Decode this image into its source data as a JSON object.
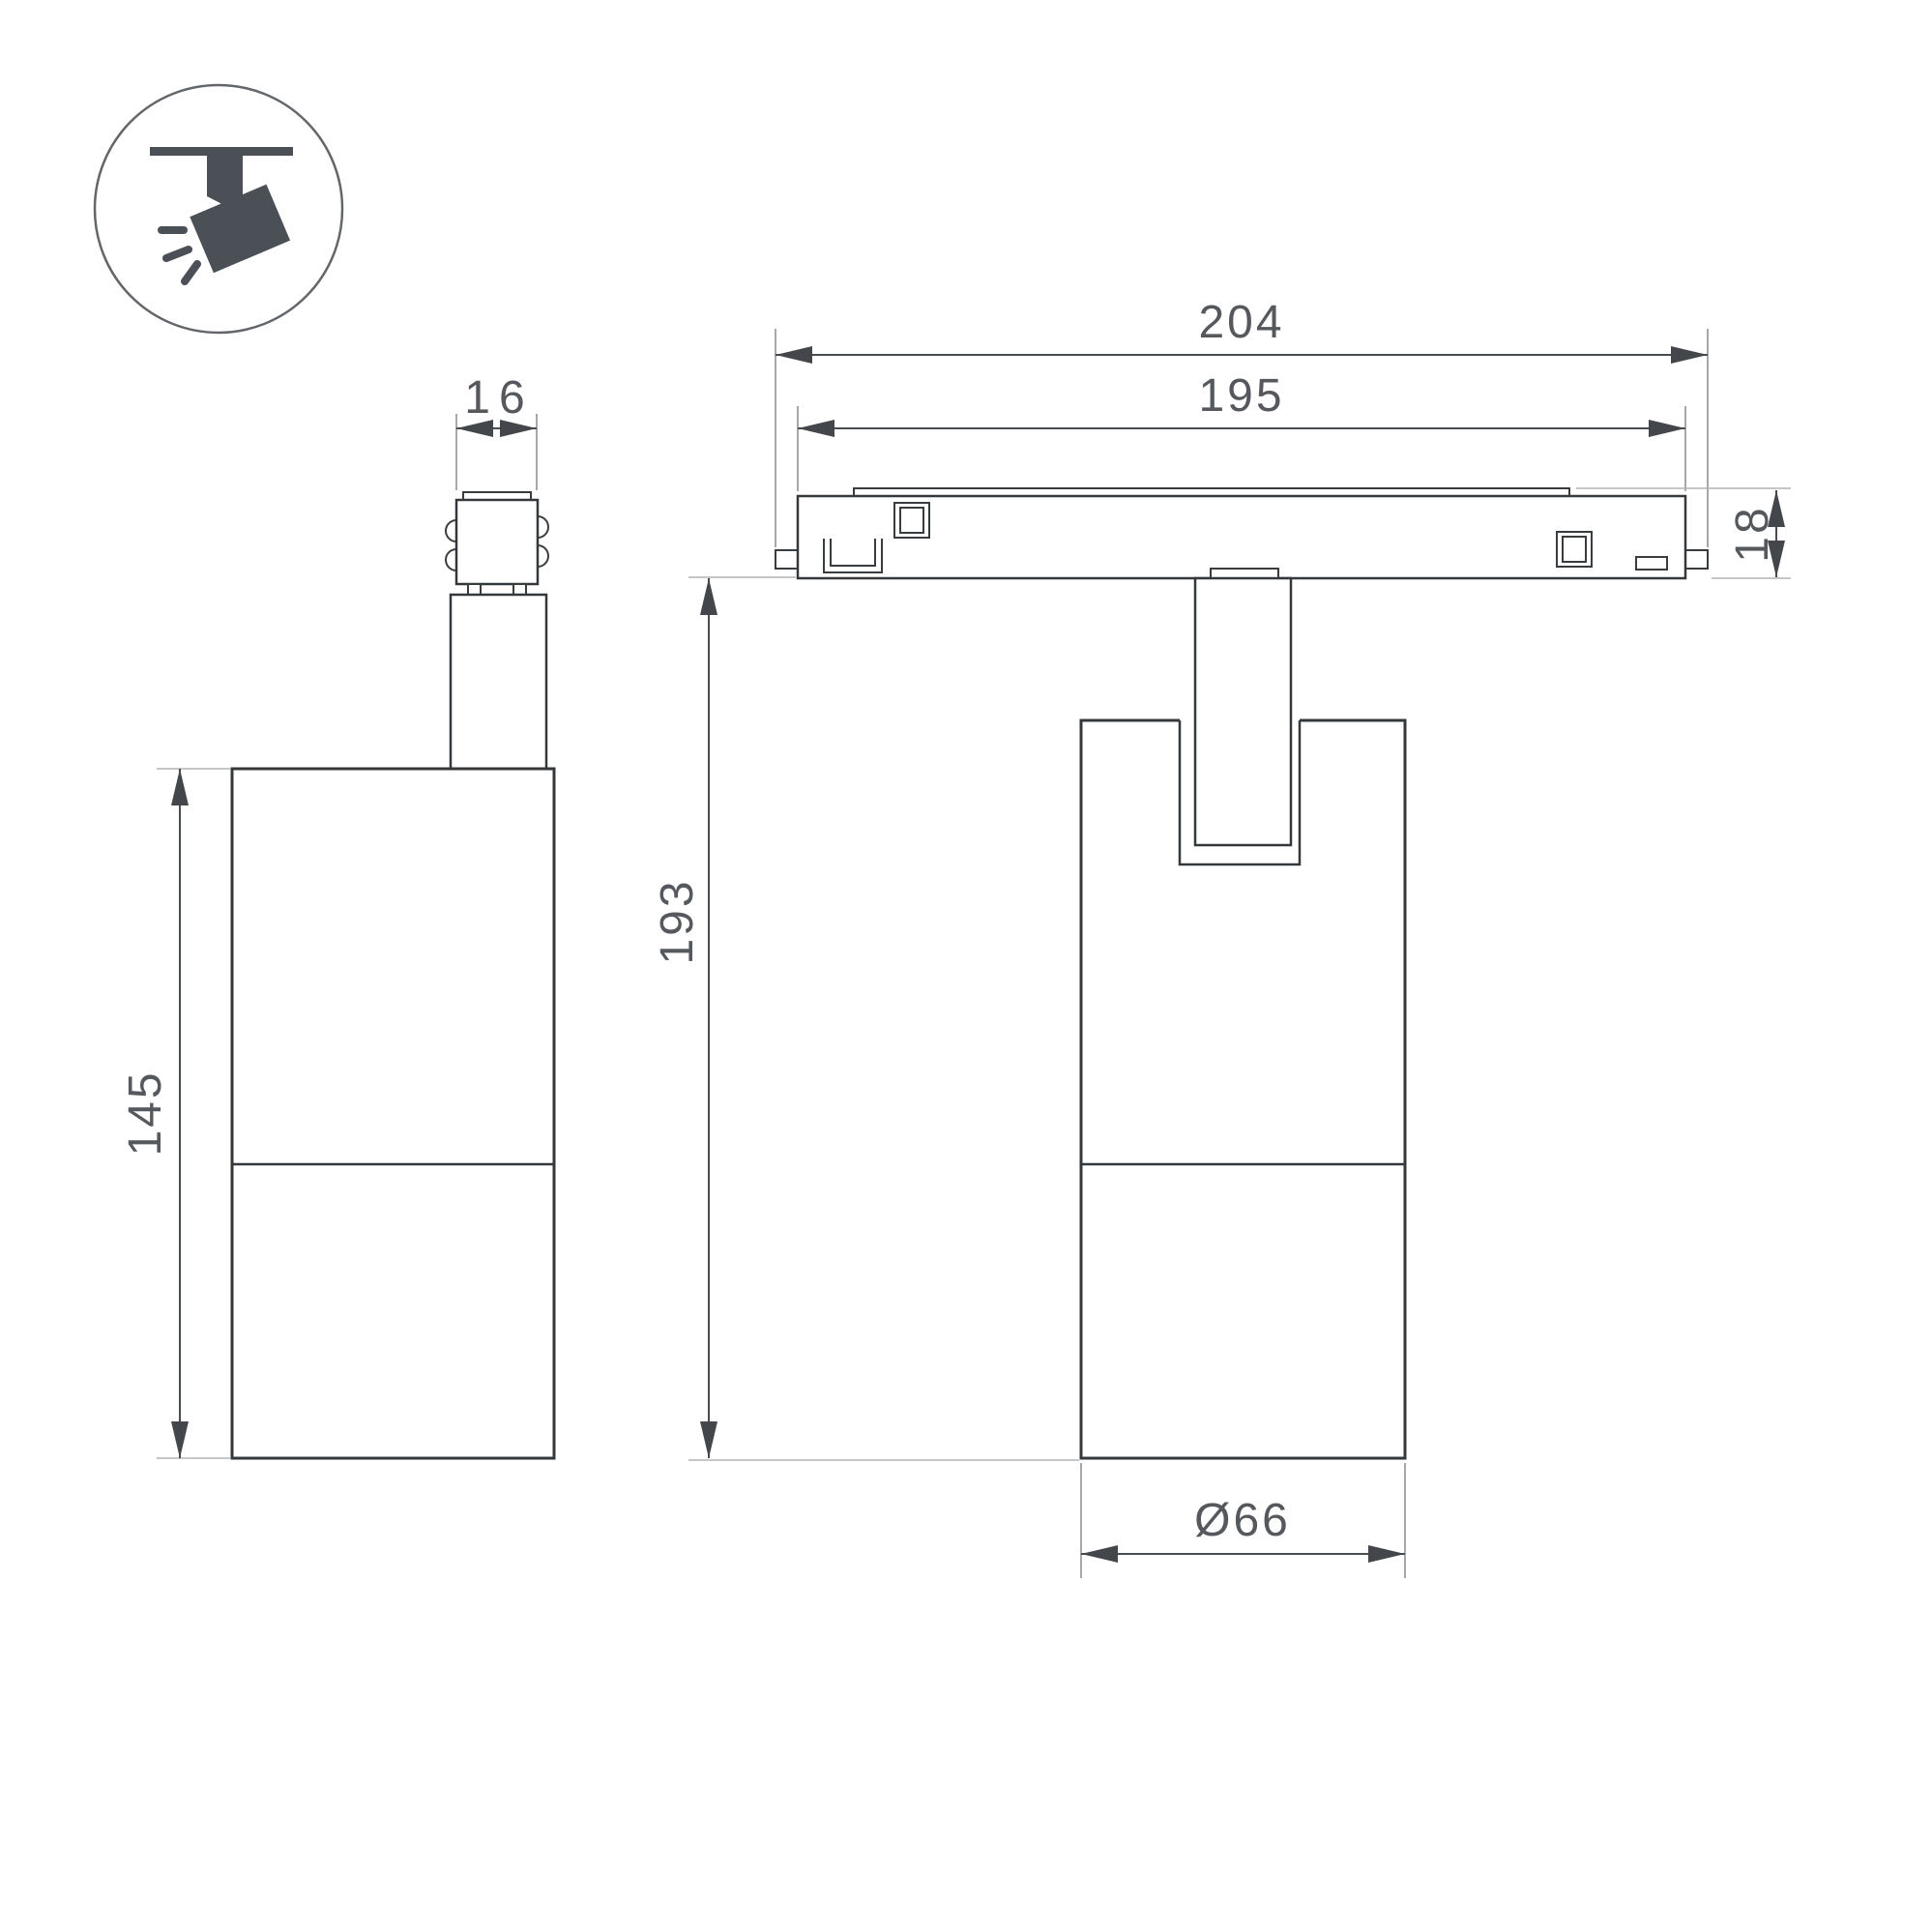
{
  "drawing": {
    "type": "technical dimension drawing",
    "subject": "magnetic track spotlight luminaire",
    "icon": {
      "name": "track-spotlight-icon"
    },
    "views": {
      "side_view": {
        "dim_connector_width": "16",
        "dim_body_height": "145"
      },
      "front_view": {
        "dim_total_length": "204",
        "dim_track_length": "195",
        "dim_track_height": "18",
        "dim_overall_height": "193",
        "dim_body_diameter": "Ø66"
      }
    },
    "colors": {
      "outline": "#35383b",
      "dimension": "#4a4d50",
      "extension_line": "#b0b3b5",
      "text": "#55585c",
      "icon_fill": "#4a5056",
      "background": "#ffffff"
    }
  }
}
